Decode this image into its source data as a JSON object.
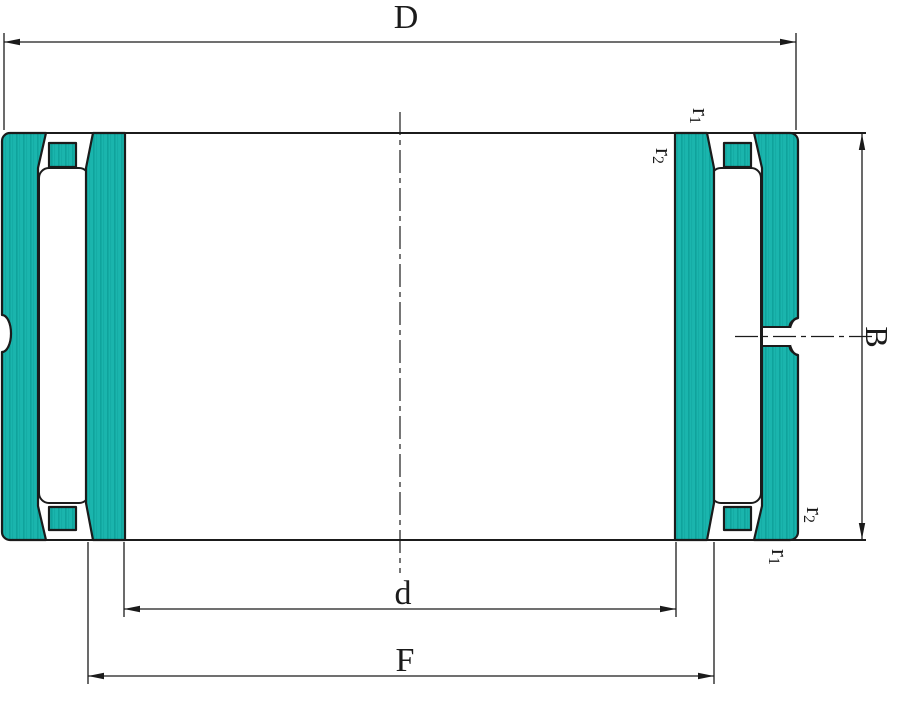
{
  "title": "Needle roller bearing cross-section drawing",
  "colors": {
    "ring_fill": "#1ab5ad",
    "ring_streak": "#0fa39c",
    "outline": "#1b1b1b",
    "dim_line": "#1b1b1b",
    "background": "#ffffff"
  },
  "labels": {
    "outer_diameter": "D",
    "bore_diameter": "d",
    "inner_raceway_diameter": "F",
    "width": "B",
    "chamfer_r1": {
      "base": "r",
      "sub": "1"
    },
    "chamfer_r2": {
      "base": "r",
      "sub": "2"
    }
  }
}
